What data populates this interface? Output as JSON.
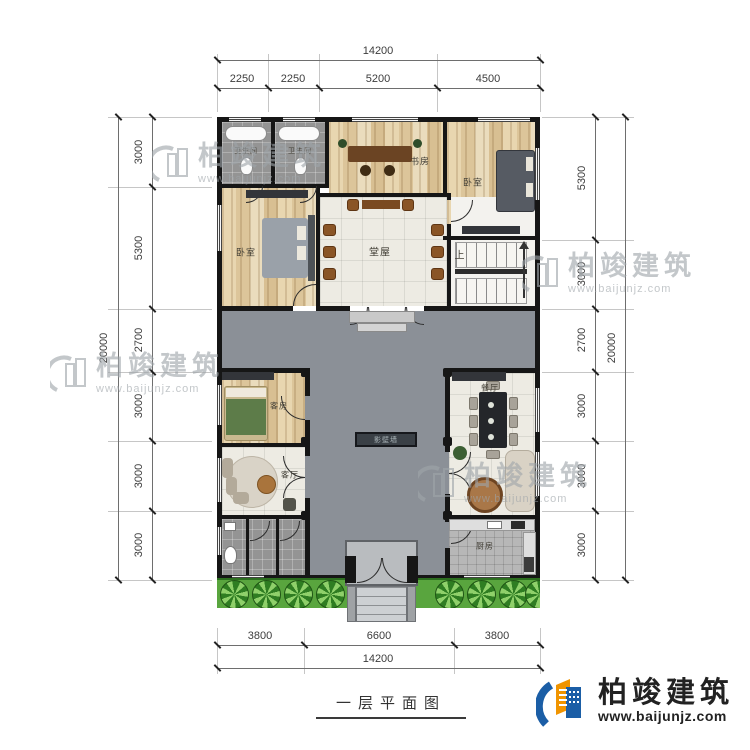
{
  "title": "一层平面图",
  "logo": {
    "name": "柏竣建筑",
    "url": "www.baijunjz.com"
  },
  "watermark": {
    "name": "柏竣建筑",
    "url": "www.baijunjz.com"
  },
  "rooms": {
    "bathroom_left": "卫生间",
    "bathroom_right": "卫生间",
    "study": "书房",
    "bedroom_top": "卧室",
    "bedroom_left": "卧室",
    "hall": "堂屋",
    "stairs_up": "上",
    "guest_room": "客房",
    "living_room": "客厅",
    "dining_room": "餐厅",
    "kitchen": "厨房",
    "screen_wall": "影壁墙"
  },
  "dimensions": {
    "top": {
      "total": "14200",
      "segments": [
        "2250",
        "2250",
        "5200",
        "4500"
      ]
    },
    "bottom": {
      "total": "14200",
      "segments": [
        "3800",
        "6600",
        "3800"
      ]
    },
    "left": {
      "total": "20000",
      "segments": [
        "3000",
        "5300",
        "2700",
        "3000",
        "3000",
        "3000"
      ]
    },
    "right": {
      "total": "20000",
      "segments": [
        "5300",
        "3000",
        "2700",
        "3000",
        "3000",
        "3000"
      ]
    }
  },
  "colors": {
    "wall": "#161616",
    "courtyard": "#8b9097",
    "wood_floor": "#e0c9a2",
    "grass": "#59a53e",
    "logo_blue": "#1b5ea6",
    "logo_orange": "#f09400"
  }
}
